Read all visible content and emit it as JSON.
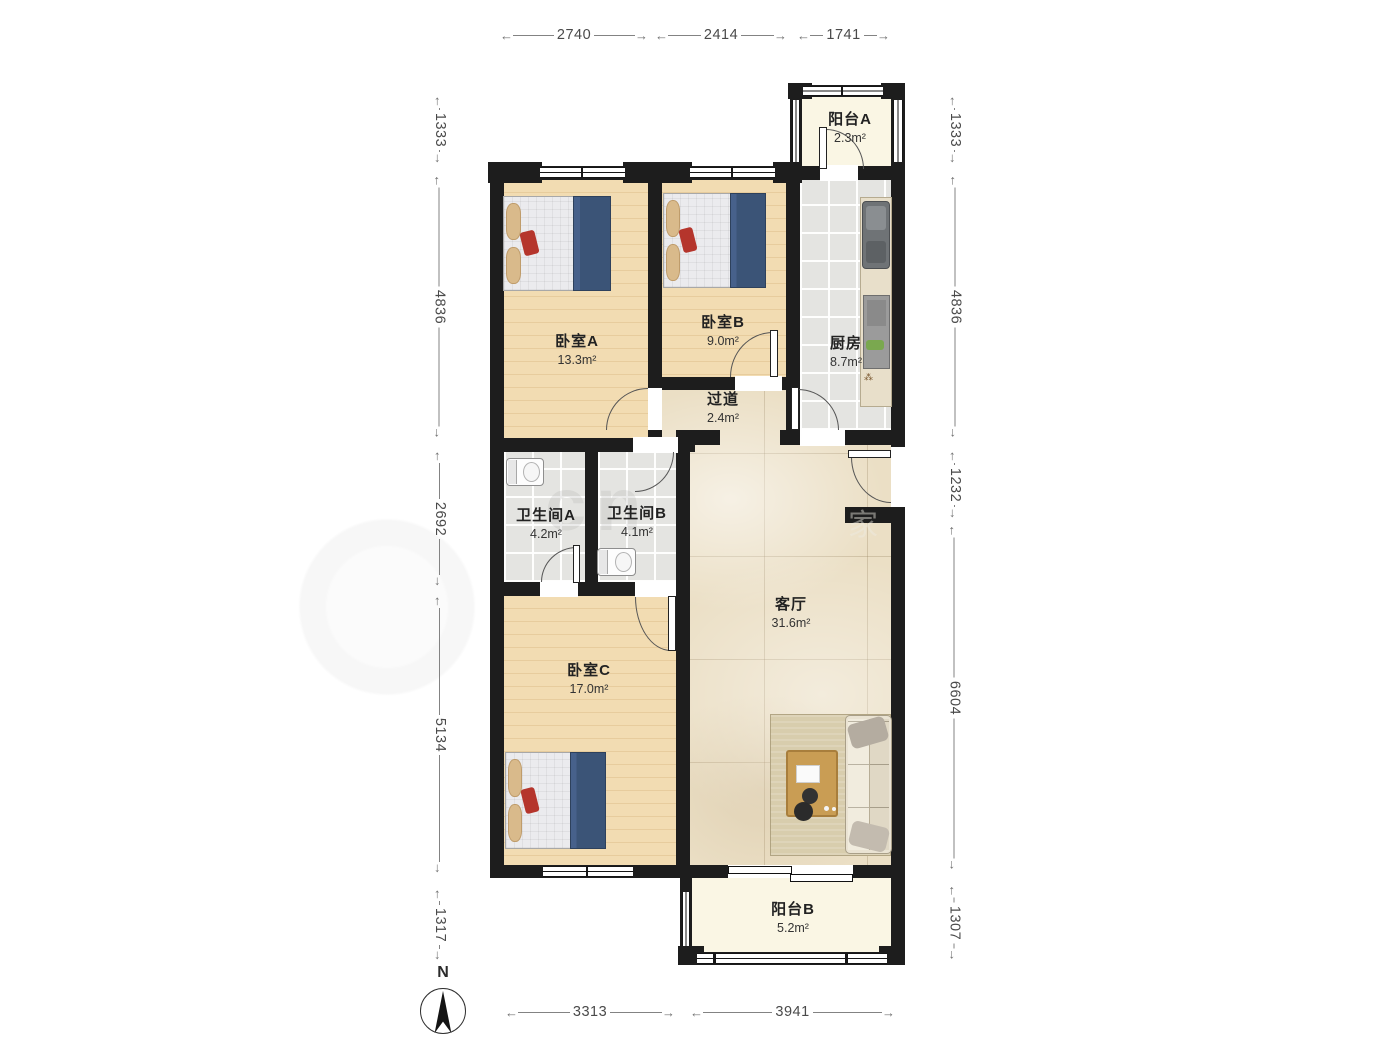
{
  "dims": {
    "top": [
      "2740",
      "2414",
      "1741"
    ],
    "bottom": [
      "3313",
      "3941"
    ],
    "left": [
      "1333",
      "4836",
      "2692",
      "5134",
      "1317"
    ],
    "right": [
      "1333",
      "4836",
      "1232",
      "6604",
      "1307"
    ]
  },
  "rooms": [
    {
      "name": "阳台A",
      "area": "2.3m²"
    },
    {
      "name": "卧室A",
      "area": "13.3m²"
    },
    {
      "name": "卧室B",
      "area": "9.0m²"
    },
    {
      "name": "厨房",
      "area": "8.7m²"
    },
    {
      "name": "过道",
      "area": "2.4m²"
    },
    {
      "name": "卫生间A",
      "area": "4.2m²"
    },
    {
      "name": "卫生间B",
      "area": "4.1m²"
    },
    {
      "name": "客厅",
      "area": "31.6m²"
    },
    {
      "name": "卧室C",
      "area": "17.0m²"
    },
    {
      "name": "阳台B",
      "area": "5.2m²"
    }
  ],
  "compass": {
    "label": "N"
  },
  "watermark": {
    "fragments": [
      "cn",
      "家"
    ]
  },
  "colors": {
    "wall": "#1d1d1d",
    "wood": "#f2dcb2",
    "tile": "#e4e4e1",
    "marble": "#ebdfc5",
    "balcony": "#faf6e4",
    "blanket": "#3b5477"
  }
}
